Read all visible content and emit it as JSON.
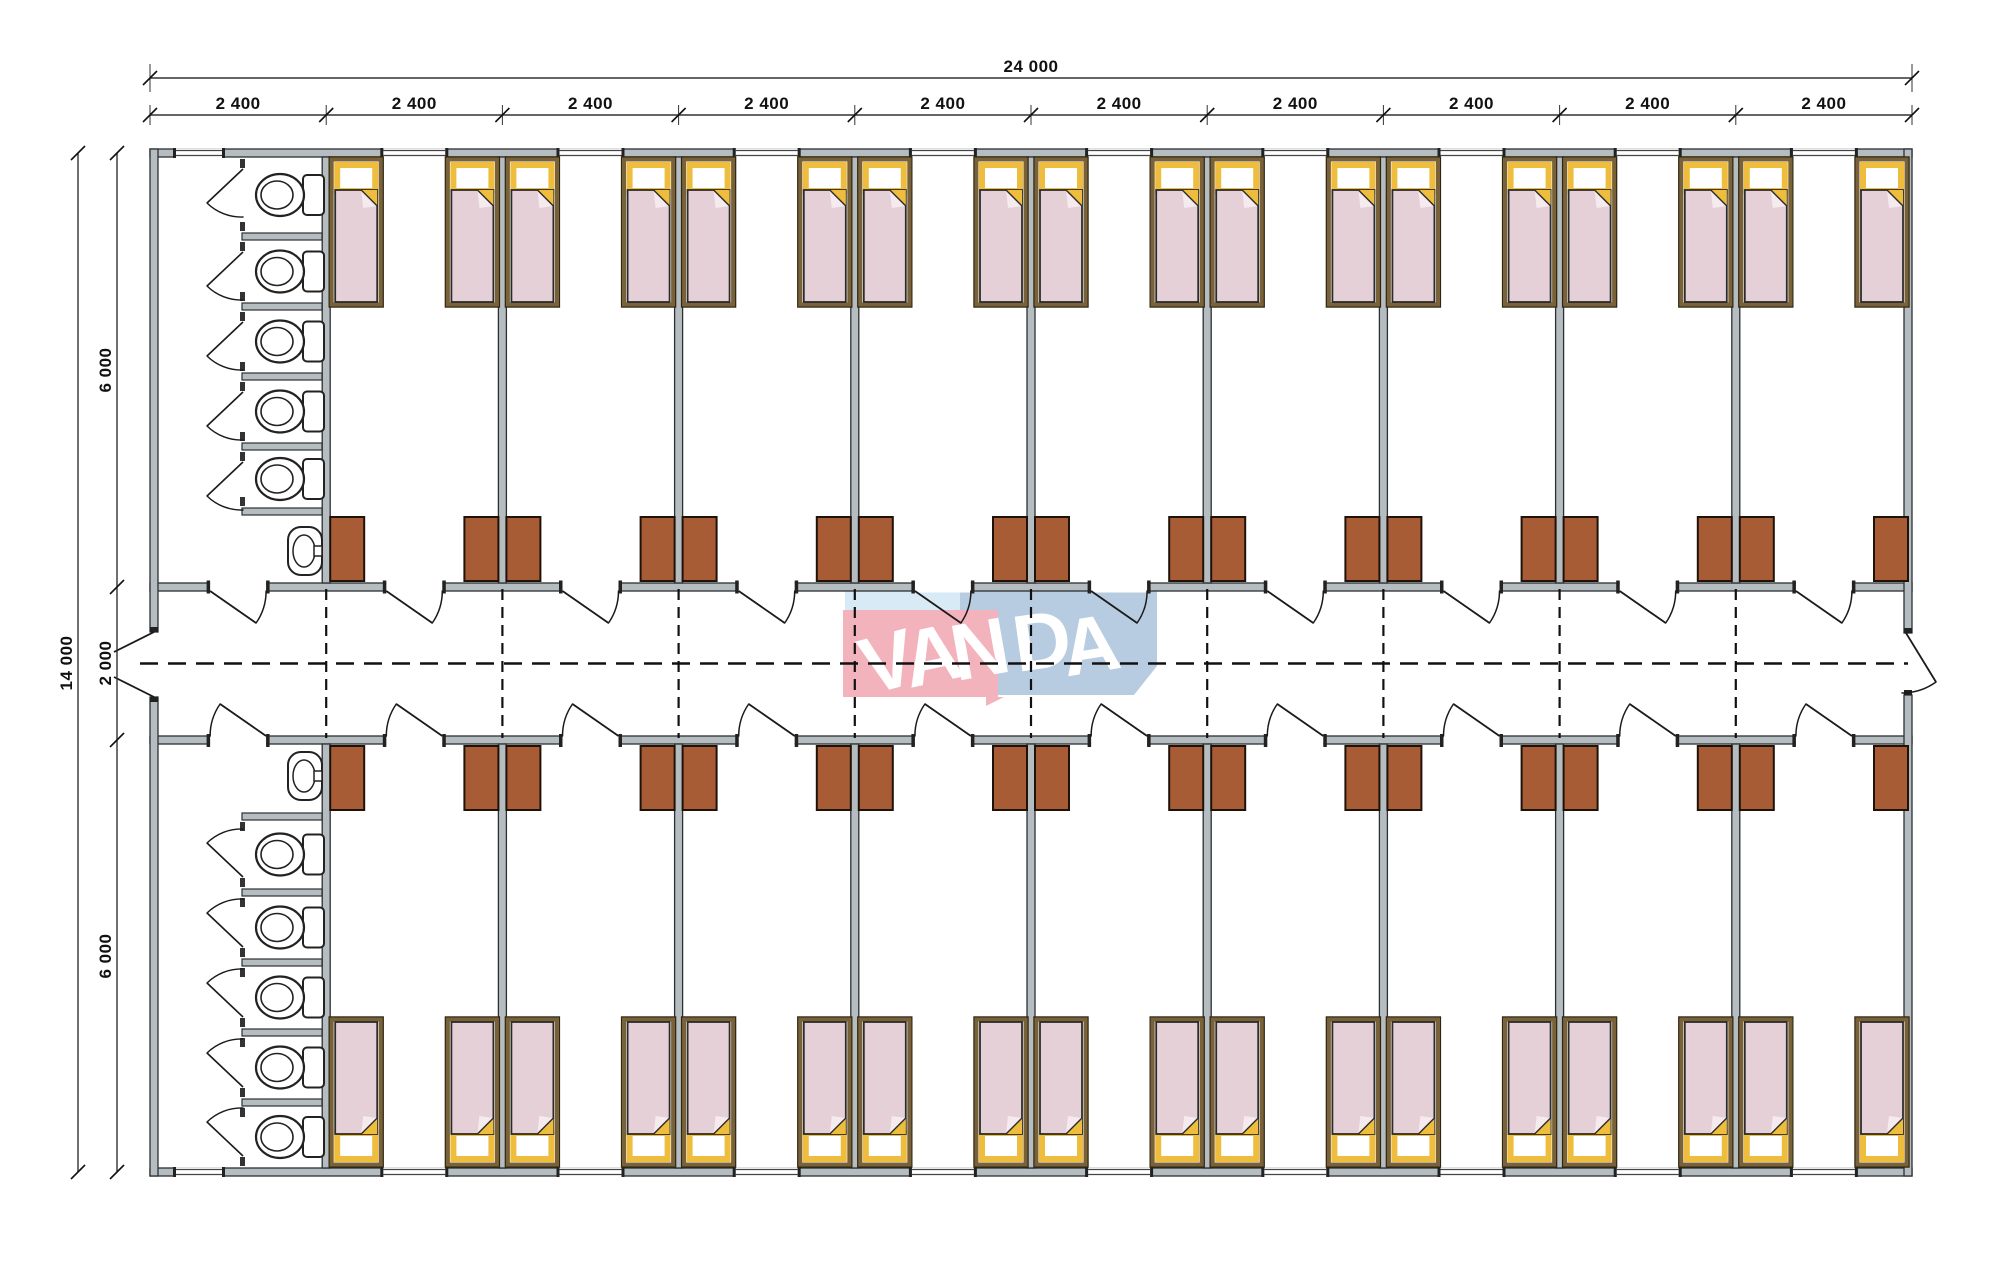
{
  "drawing": {
    "type": "dormitory container floor plan",
    "watermark": {
      "text": "VANDA",
      "letters": [
        "V",
        "A",
        "N",
        "D",
        "A"
      ],
      "pink_block": "#f3b3bd",
      "blue_block": "#b7cce1",
      "light_blue_block": "#d9eaf7",
      "text_color": "#ffffff"
    },
    "dimensions": {
      "top_overall": "24 000",
      "top_segments": [
        "2 400",
        "2 400",
        "2 400",
        "2 400",
        "2 400",
        "2 400",
        "2 400",
        "2 400",
        "2 400",
        "2 400"
      ],
      "left_overall": "14 000",
      "left_segments": [
        "6 000",
        "2 000",
        "6 000"
      ]
    },
    "layout": {
      "modules": 10,
      "rooms_top_band": 9,
      "rooms_bottom_band": 9,
      "beds_per_room": 2,
      "wardrobes_per_room": 2,
      "washrooms": 2,
      "wc_stalls_per_washroom": 5,
      "sinks_per_washroom": 1,
      "corridor_position": "central",
      "corridor_centerline": "dashed"
    },
    "colors": {
      "background": "#ffffff",
      "wall_fill": "#b6bdc1",
      "wall_line": "#2b3033",
      "bed_frame": "#7a6238",
      "bed_frame_dark": "#2e2512",
      "blanket": "#e6d0d8",
      "blanket_line": "#2b2b2b",
      "pillow_yellow": "#eebd3e",
      "fold_flap": "#f5eaee",
      "cabinet_fill": "#a85c36",
      "cabinet_line": "#1f1209",
      "fixture_line": "#222222",
      "dash_line": "#111111",
      "dim_line": "#333333",
      "dim_text": "#111111"
    }
  }
}
